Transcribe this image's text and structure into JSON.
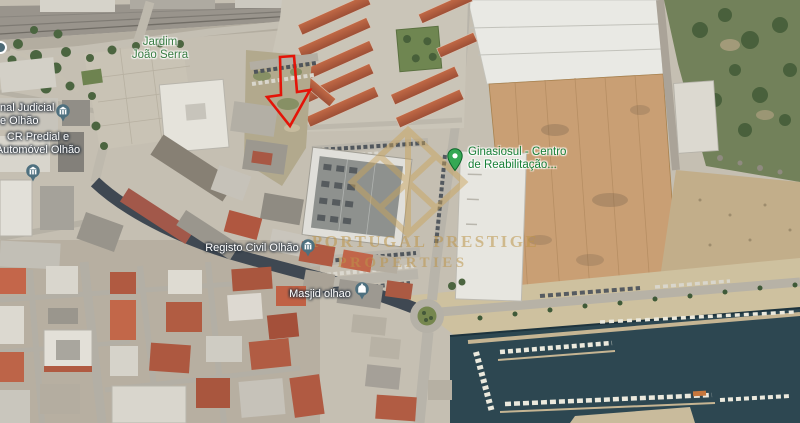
{
  "labels": {
    "jardim_joao_serra": {
      "line1": "Jardim",
      "line2": "João Serra",
      "color": "#3a7d44",
      "type": "park"
    },
    "tribunal_judicial": {
      "line1": "nal Judicial",
      "line2": "e Olhão",
      "color": "#ffffff",
      "type": "civic",
      "truncated": true
    },
    "cr_predial": {
      "line1": "CR Predial e",
      "line2": "Automóvel Olhão",
      "color": "#ffffff",
      "type": "civic"
    },
    "registo_civil": {
      "text": "Registo Civil Olhão",
      "color": "#ffffff",
      "type": "civic"
    },
    "masjid_olhao": {
      "text": "Masjid olhao",
      "color": "#ffffff",
      "type": "place_of_worship"
    },
    "ginasiosul": {
      "line1": "Ginasiosul - Centro",
      "line2": "de Reabilitação...",
      "color": "#188038",
      "type": "health"
    }
  },
  "pins": {
    "civic_pin_color": "#4e707f",
    "health_pin_color": "#34a853",
    "icons": {
      "tribunal_judicial": "government-building-pin",
      "cr_predial": "government-building-pin",
      "registo_civil": "government-building-pin",
      "masjid_olhao": "mosque-pin",
      "ginasiosul": "green-place-pin",
      "station": "transit-stop-icon-partial"
    }
  },
  "watermark": {
    "line1": "PORTUGAL PRESTIGE",
    "line2": "PROPERTIES",
    "logo": "gold-diamond-monogram",
    "color": "#bd9549"
  },
  "annotation": {
    "arrow_color": "#e41408",
    "arrow_direction": "down"
  },
  "map_colors": {
    "water": "#2d4751",
    "vegetation": "#72815a",
    "warehouse_roof": "#c99f74",
    "dark_avenue": "#3f4852",
    "red_roofs": "#b25c3f",
    "ground": "#c5bfb2"
  }
}
